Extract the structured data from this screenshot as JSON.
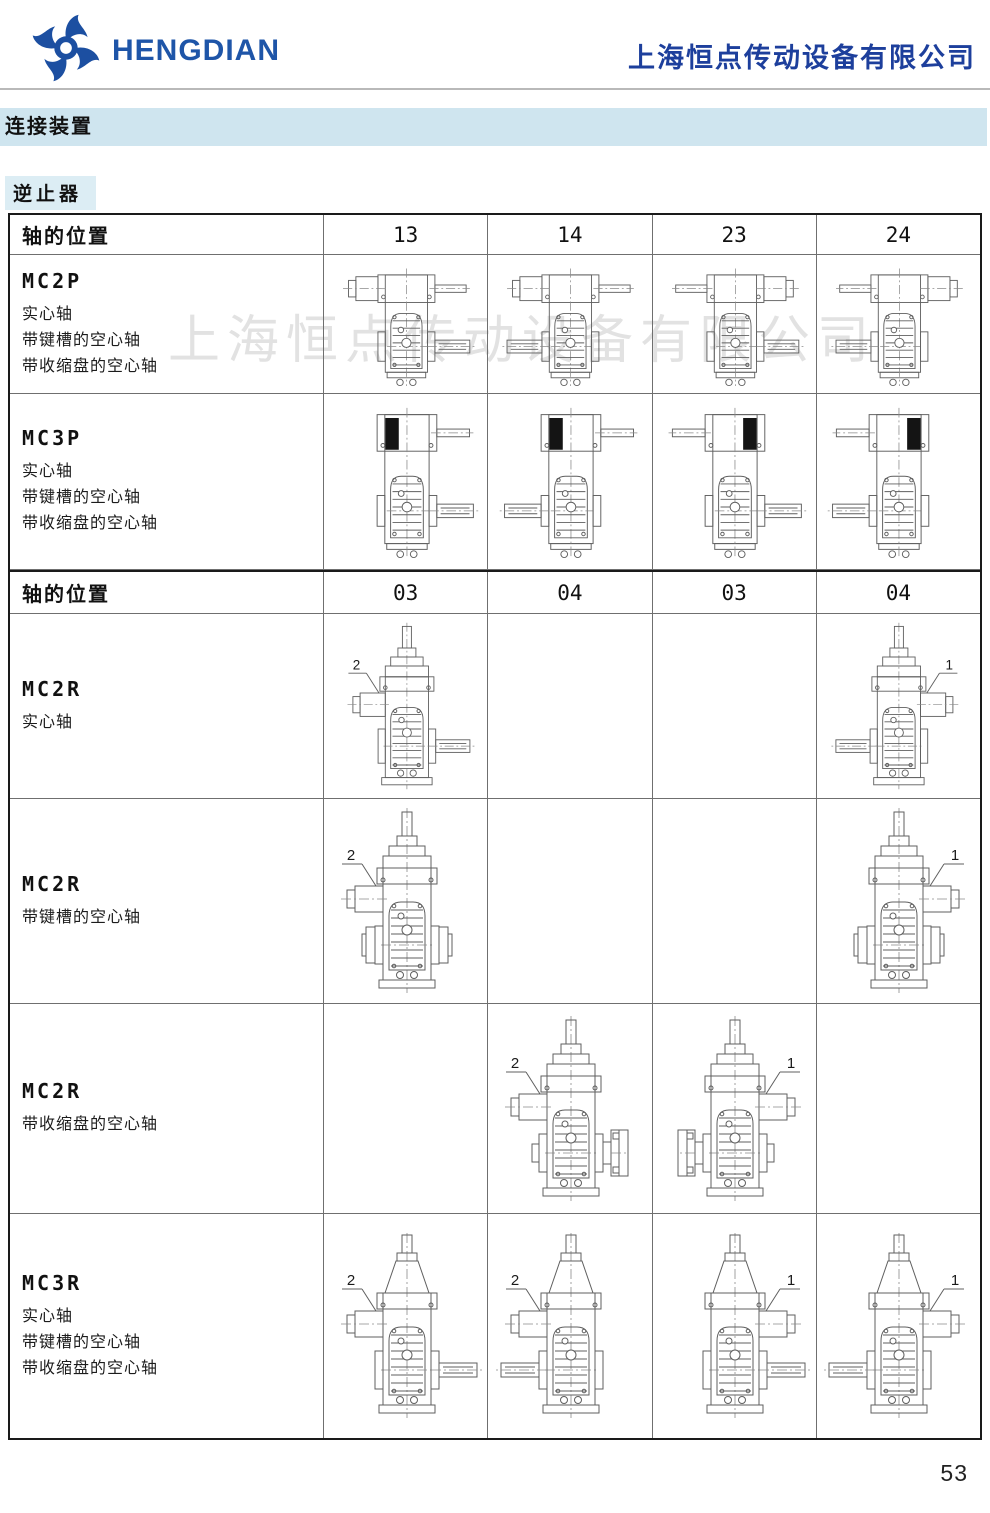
{
  "header": {
    "logo_text": "HENGDIAN",
    "company_name": "上海恒点传动设备有限公司"
  },
  "section": {
    "title": "连接装置",
    "subtitle": "逆止器"
  },
  "watermark": {
    "text": "上海恒点传动设备有限公司"
  },
  "page": {
    "number": "53"
  },
  "colors": {
    "brand_blue": "#1e55a8",
    "company_blue": "#1d3f9c",
    "band_background": "#cfe5ef",
    "subsection_background": "#dcedf4",
    "watermark_gray": "#e2e2e2",
    "drawing_stroke": "#5f5f5f",
    "backstop_fill": "#141414"
  },
  "table": {
    "groups": [
      {
        "header": {
          "label": "轴的位置",
          "columns": [
            "13",
            "14",
            "23",
            "24"
          ],
          "height": 40
        },
        "rows": [
          {
            "model": "MC2P",
            "descriptions": [
              "实心轴",
              "带键槽的空心轴",
              "带收缩盘的空心轴"
            ],
            "row_height": 139,
            "cells": [
              {
                "kind": "P",
                "stage": 2,
                "input_type": "coupling",
                "input_side": "left",
                "output_side": "right"
              },
              {
                "kind": "P",
                "stage": 2,
                "input_type": "coupling",
                "input_side": "left",
                "output_side": "left"
              },
              {
                "kind": "P",
                "stage": 2,
                "input_type": "coupling",
                "input_side": "right",
                "output_side": "right"
              },
              {
                "kind": "P",
                "stage": 2,
                "input_type": "coupling",
                "input_side": "right",
                "output_side": "left"
              }
            ]
          },
          {
            "model": "MC3P",
            "descriptions": [
              "实心轴",
              "带键槽的空心轴",
              "带收缩盘的空心轴"
            ],
            "row_height": 176,
            "cells": [
              {
                "kind": "P",
                "stage": 3,
                "input_type": "backstop",
                "input_side": "left",
                "output_side": "right"
              },
              {
                "kind": "P",
                "stage": 3,
                "input_type": "backstop",
                "input_side": "left",
                "output_side": "left"
              },
              {
                "kind": "P",
                "stage": 3,
                "input_type": "backstop",
                "input_side": "right",
                "output_side": "right"
              },
              {
                "kind": "P",
                "stage": 3,
                "input_type": "backstop",
                "input_side": "right",
                "output_side": "left"
              }
            ]
          }
        ]
      },
      {
        "header": {
          "label": "轴的位置",
          "columns": [
            "03",
            "04",
            "03",
            "04"
          ],
          "height": 44
        },
        "rows": [
          {
            "model": "MC2R",
            "descriptions": [
              "实心轴"
            ],
            "row_height": 185,
            "cells": [
              {
                "kind": "R",
                "stage": 2,
                "coupling_side": "left",
                "marker": "2",
                "output": "solid",
                "output_side": "right"
              },
              null,
              null,
              {
                "kind": "R",
                "stage": 2,
                "coupling_side": "right",
                "marker": "1",
                "output": "solid",
                "output_side": "left"
              }
            ]
          },
          {
            "model": "MC2R",
            "descriptions": [
              "带键槽的空心轴"
            ],
            "row_height": 205,
            "cells": [
              {
                "kind": "R",
                "stage": 2,
                "coupling_side": "left",
                "marker": "2",
                "output": "hub"
              },
              null,
              null,
              {
                "kind": "R",
                "stage": 2,
                "coupling_side": "right",
                "marker": "1",
                "output": "hub"
              }
            ]
          },
          {
            "model": "MC2R",
            "descriptions": [
              "带收缩盘的空心轴"
            ],
            "row_height": 210,
            "cells": [
              null,
              {
                "kind": "R",
                "stage": 2,
                "coupling_side": "left",
                "marker": "2",
                "output": "shrink",
                "output_side": "right"
              },
              {
                "kind": "R",
                "stage": 2,
                "coupling_side": "right",
                "marker": "1",
                "output": "shrink",
                "output_side": "left"
              },
              null
            ]
          },
          {
            "model": "MC3R",
            "descriptions": [
              "实心轴",
              "带键槽的空心轴",
              "带收缩盘的空心轴"
            ],
            "row_height": 224,
            "cells": [
              {
                "kind": "R",
                "stage": 3,
                "coupling_side": "left",
                "marker": "2",
                "output": "solid",
                "output_side": "right"
              },
              {
                "kind": "R",
                "stage": 3,
                "coupling_side": "left",
                "marker": "2",
                "output": "solid",
                "output_side": "left"
              },
              {
                "kind": "R",
                "stage": 3,
                "coupling_side": "right",
                "marker": "1",
                "output": "solid",
                "output_side": "right"
              },
              {
                "kind": "R",
                "stage": 3,
                "coupling_side": "right",
                "marker": "1",
                "output": "solid",
                "output_side": "left"
              }
            ]
          }
        ]
      }
    ]
  }
}
